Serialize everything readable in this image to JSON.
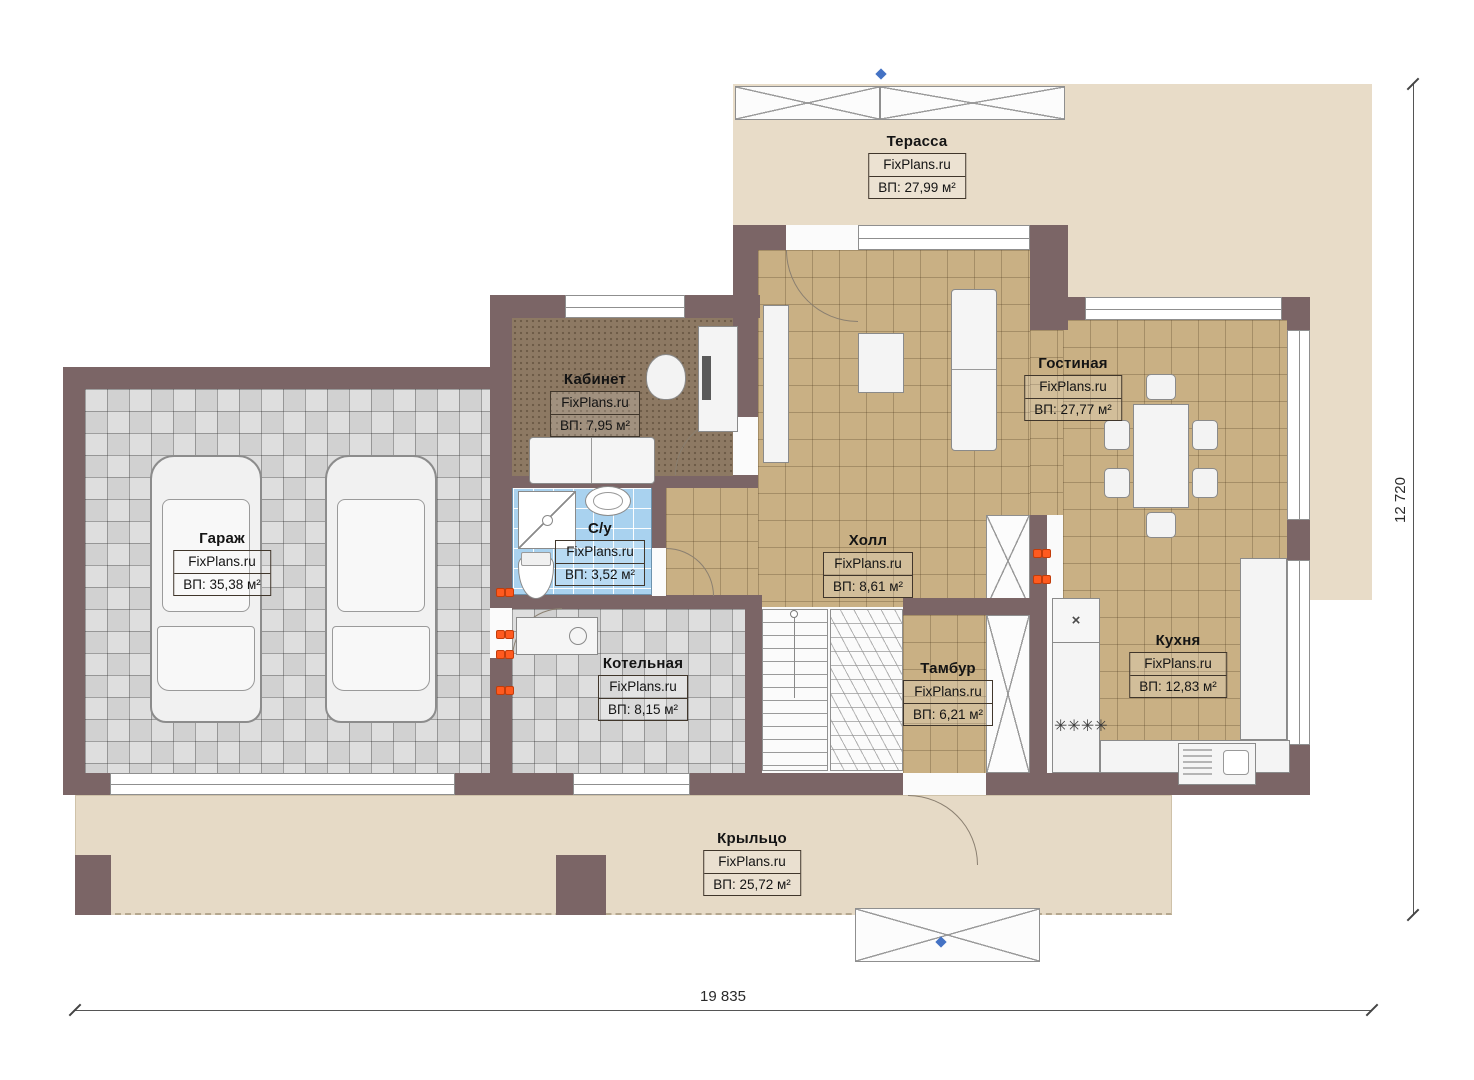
{
  "brand": "FixPlans.ru",
  "rooms": {
    "terrace": {
      "name": "Терасса",
      "area": "ВП: 27,99 м²"
    },
    "office": {
      "name": "Кабинет",
      "area": "ВП: 7,95 м²"
    },
    "living": {
      "name": "Гостиная",
      "area": "ВП: 27,77 м²"
    },
    "garage": {
      "name": "Гараж",
      "area": "ВП: 35,38 м²"
    },
    "bathroom": {
      "name": "С/у",
      "area": "ВП: 3,52 м²"
    },
    "hall": {
      "name": "Холл",
      "area": "ВП: 8,61 м²"
    },
    "kitchen": {
      "name": "Кухня",
      "area": "ВП: 12,83 м²"
    },
    "boiler": {
      "name": "Котельная",
      "area": "ВП: 8,15 м²"
    },
    "vestibule": {
      "name": "Тамбур",
      "area": "ВП: 6,21 м²"
    },
    "porch": {
      "name": "Крыльцо",
      "area": "ВП: 25,72 м²"
    }
  },
  "dimensions": {
    "overall_width_mm": "19 835",
    "overall_depth_mm": "12 720"
  },
  "icons": {
    "stove_burners": "✳✳✳✳",
    "appliance_cross": "×"
  },
  "colors": {
    "wall": "#7b6566",
    "tile_tan": "#c9b084",
    "tile_blue": "#a9d2ef",
    "tile_gray": "#dedede",
    "office_brown": "#8d7963",
    "terrace_beige": "#e8dcc8",
    "porch_beige": "#e6dac6",
    "accent_orange": "#ff5a1f",
    "marker_blue": "#4472c4"
  }
}
